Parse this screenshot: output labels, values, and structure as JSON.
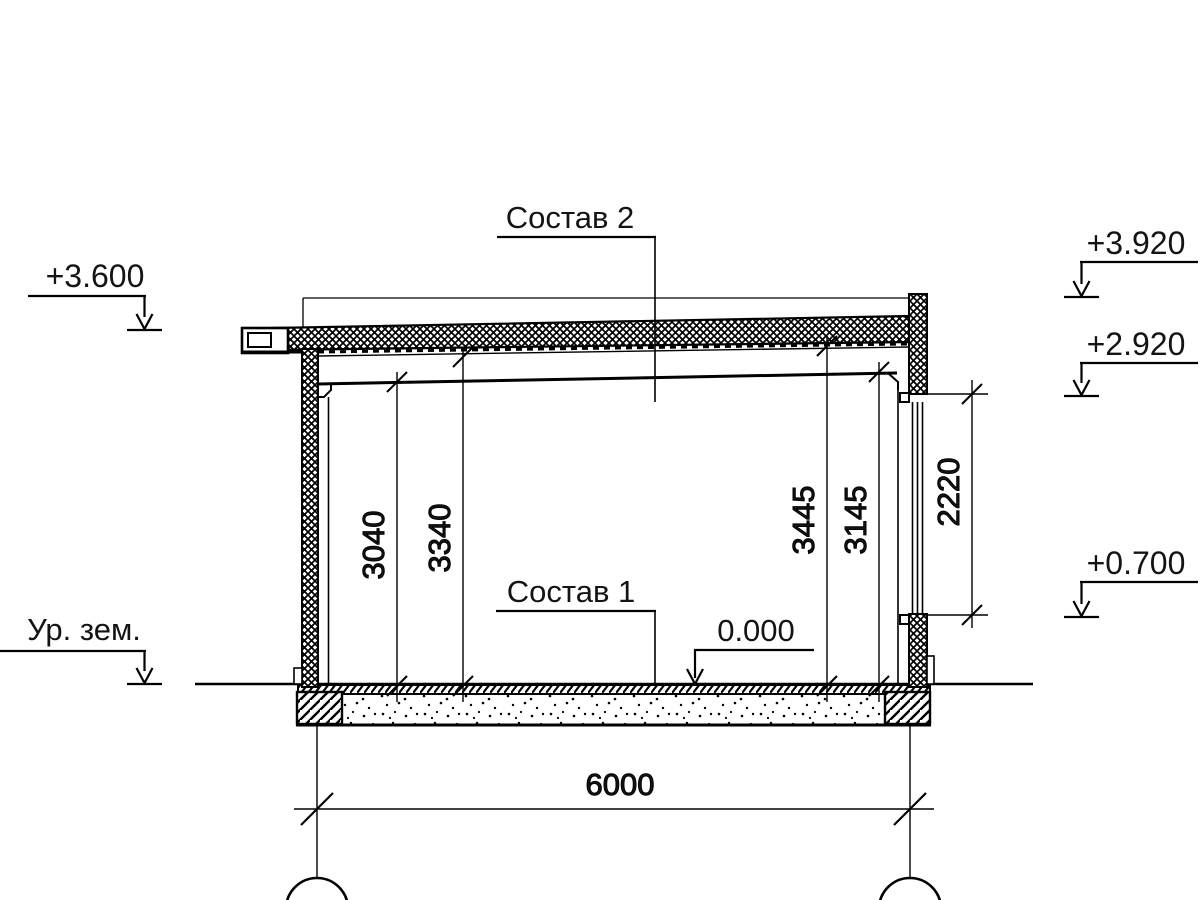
{
  "drawing": {
    "type": "building-section",
    "labels": {
      "roof_composition": "Состав 2",
      "floor_composition": "Состав 1",
      "floor_level": "0.000",
      "ground_level": "Ур. зем."
    },
    "elevation_marks": {
      "roof_left": "+3.600",
      "parapet_right": "+3.920",
      "window_head_right": "+2.920",
      "window_sill_right": "+0.700"
    },
    "dimensions": {
      "clear_height_left": "3040",
      "ceiling_height_left": "3340",
      "ceiling_height_right": "3445",
      "clear_height_right": "3145",
      "window_height": "2220",
      "span": "6000"
    },
    "colors": {
      "line": "#000000",
      "background": "#ffffff"
    }
  }
}
